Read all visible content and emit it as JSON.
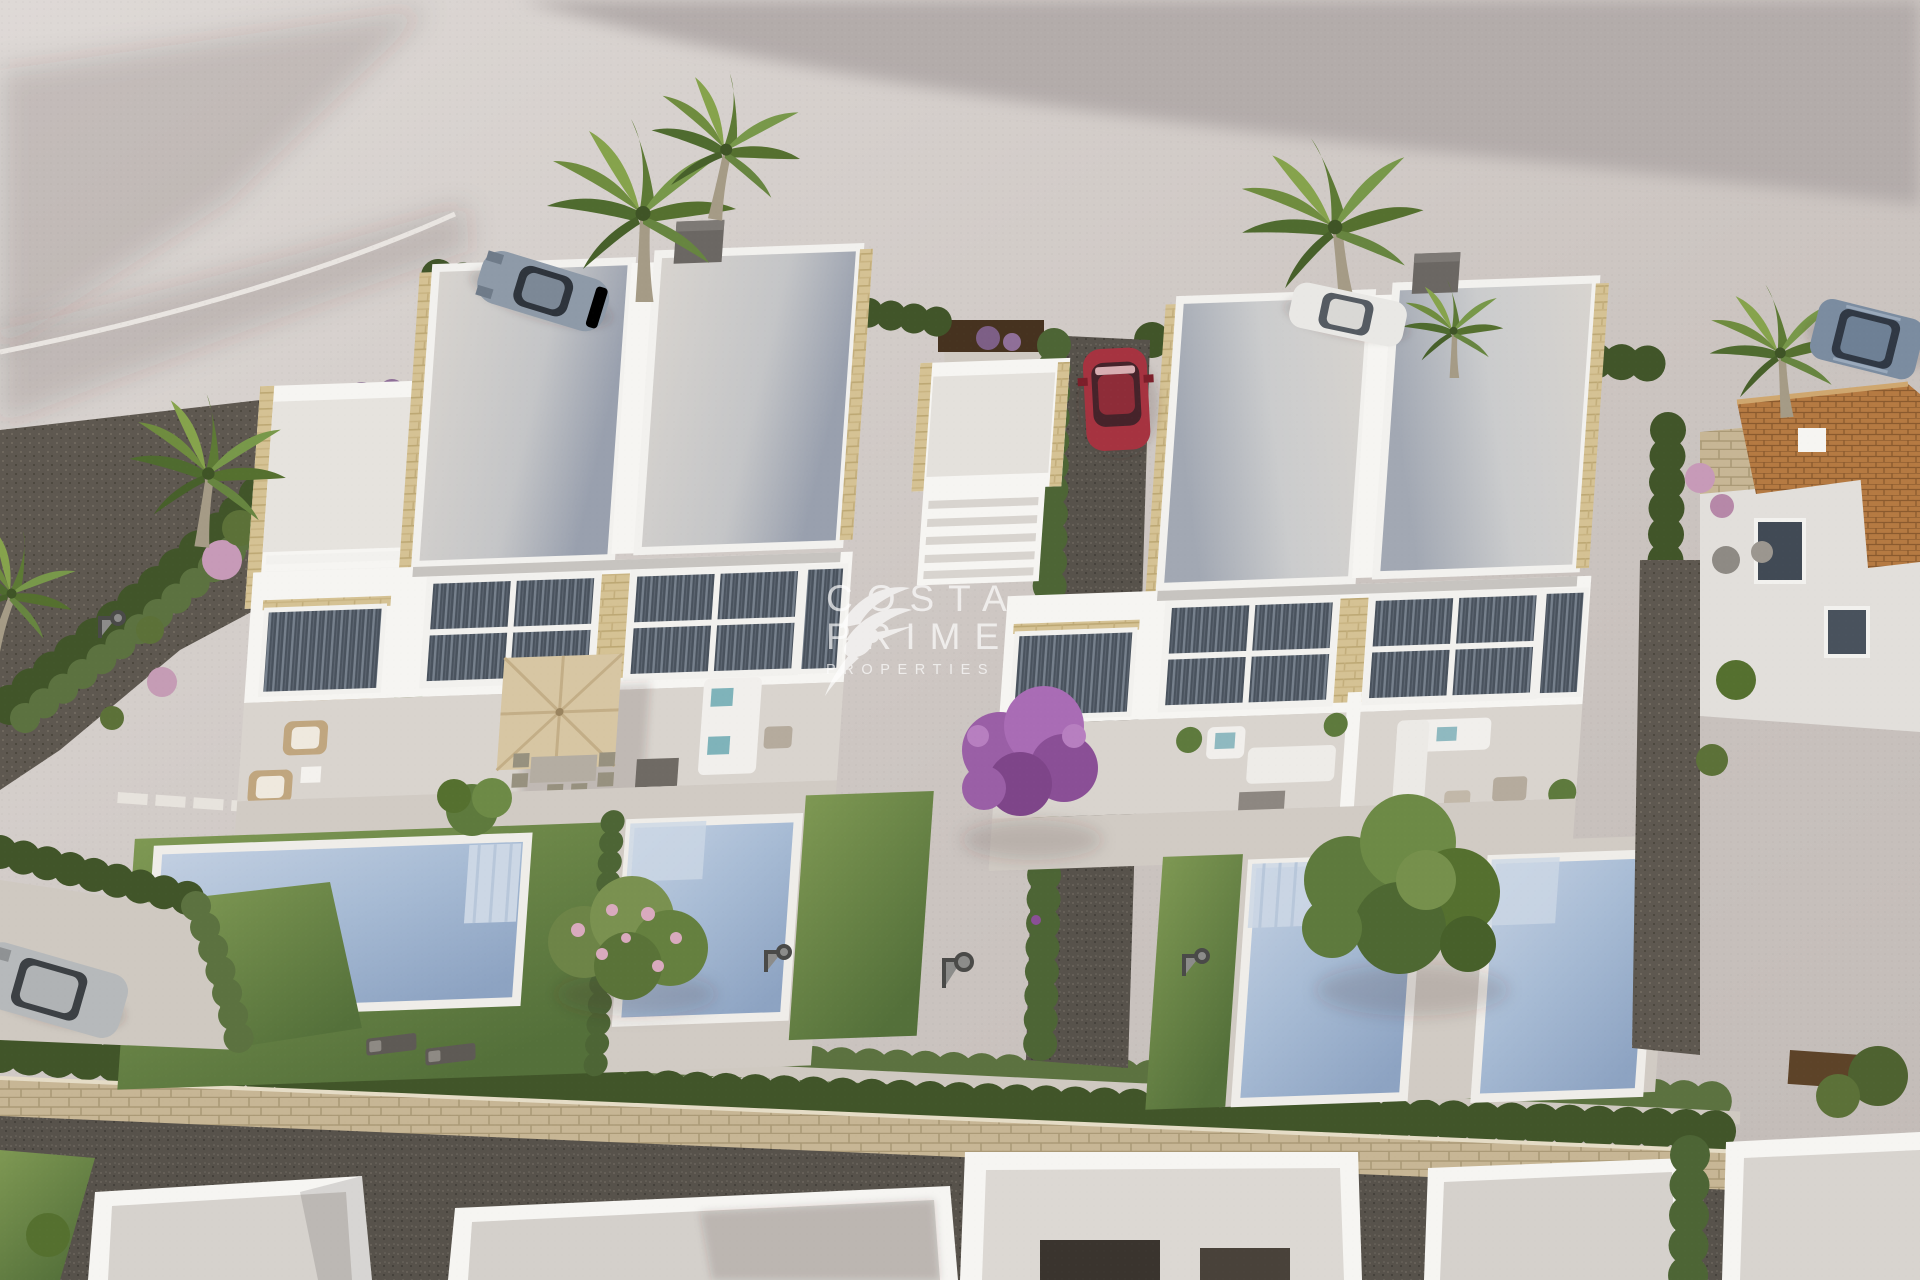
{
  "image": {
    "kind": "3d-aerial-architectural-render",
    "alt": "Aerial render of two modern white duplex villas with private pools, lawns, cypress hedges, palm trees and parked cars in a new-build residential development"
  },
  "watermark": {
    "line1": "COSTA",
    "line2": "PRIME",
    "line3": "PROPERTIES",
    "logo": "hummingbird-logo",
    "color": "#ffffff"
  },
  "colors": {
    "pavement": "#c9c2be",
    "pavementLight": "#dad5d2",
    "terrain": "#b3acaa",
    "shadow": "rgba(55,50,48,0.16)",
    "curb": "#e9e5e1",
    "roofLight": "#d8d4cf",
    "roofShade": "#99a0ae",
    "wallWhite": "#f6f5f2",
    "wallShade": "#e2dfdb",
    "wallDark": "#c7c4c0",
    "stone": "#d5c294",
    "stoneDark": "#b29d71",
    "glass": "#414a55",
    "curtain": "#7b8490",
    "frame": "#f2f1ee",
    "terrace": "#d9d4ce",
    "deck": "#d1cbc4",
    "lawn": "#76914d",
    "lawnDark": "#54703a",
    "hedge": "#5c7240",
    "hedgeDark": "#415529",
    "cypress": "#4d6535",
    "gravel": "#57524b",
    "bedGravel": "#5e5850",
    "water": "#aabed7",
    "waterDeep": "#8da3c2",
    "waterStep": "#ccd7e5",
    "coping": "#efede9",
    "pathLight": "#cfc9c1",
    "parasol": "#d7c6a3",
    "parasolRound": "#c9b088",
    "corten": "#46321f",
    "chimney": "#6b6763",
    "tile": "#b57a42",
    "tileLine": "#8a5a2e",
    "stoneWall": "#c7b695",
    "carSilver": "#8e9aa8",
    "carWhite": "#e9e8e5",
    "carSuv": "#7b8ca0",
    "carRed": "#a63340",
    "carGray": "#b6b9bb",
    "carGlass": "#2f353d",
    "treeGreen": "#5e7a3d",
    "treePink": "#d9aabe",
    "treePurple": "#9a5fa6",
    "trunk": "#8a7a5f",
    "watermark": "#ffffff"
  }
}
